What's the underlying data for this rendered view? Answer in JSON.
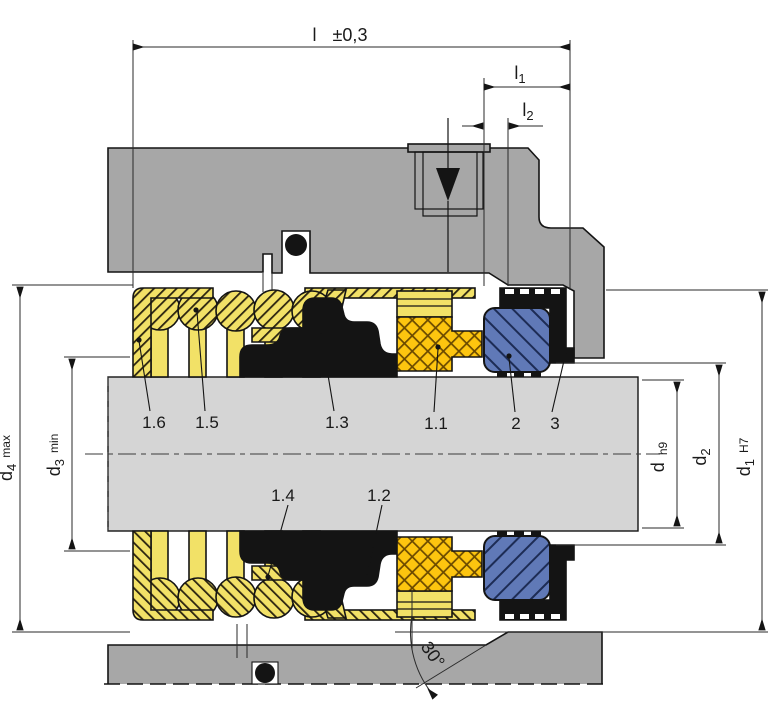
{
  "drawing": {
    "title_hint": "mechanical-seal-cross-section",
    "dimensions": {
      "length_total": {
        "base": "l",
        "tolerance": "±0,3"
      },
      "length_l1": {
        "base": "l",
        "sub": "1"
      },
      "length_l2": {
        "base": "l",
        "sub": "2"
      },
      "dia_d4": {
        "base": "d",
        "sub": "4",
        "qualifier": "max"
      },
      "dia_d3": {
        "base": "d",
        "sub": "3",
        "qualifier": "min"
      },
      "dia_d": {
        "base": "d",
        "qualifier": "h9"
      },
      "dia_d2": {
        "base": "d",
        "sub": "2"
      },
      "dia_d1": {
        "base": "d",
        "sub": "1",
        "qualifier": "H7"
      },
      "chamfer_angle": "30°"
    },
    "part_labels": {
      "p16": "1.6",
      "p15": "1.5",
      "p13": "1.3",
      "p11": "1.1",
      "p2": "2",
      "p3": "3",
      "p14": "1.4",
      "p12": "1.2"
    },
    "colors": {
      "housing_gray": "#a7a7a7",
      "shaft_gray": "#d5d5d5",
      "spring_yellow": "#f2e167",
      "face_gold": "#fdc50f",
      "seat_blue": "#6079b7",
      "elastomer_black": "#141414",
      "hatch_dark": "#2b2410",
      "gold_hatch": "#6b4a00",
      "blue_hatch": "#1d2c55",
      "line": "#1a1a1a"
    }
  }
}
